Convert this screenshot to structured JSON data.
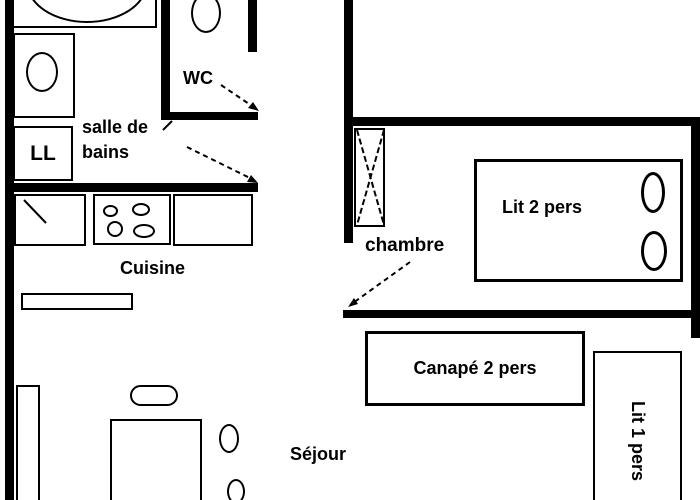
{
  "colors": {
    "ink": "#000000",
    "paper": "#ffffff"
  },
  "rooms": {
    "salle_de_bains": {
      "line1": "salle de",
      "line2": "bains"
    },
    "wc": {
      "label": "WC"
    },
    "cuisine": {
      "label": "Cuisine"
    },
    "chambre": {
      "label": "chambre"
    },
    "sejour": {
      "label": "Séjour"
    }
  },
  "furniture": {
    "washing_machine": {
      "label": "LL"
    },
    "double_bed": {
      "label": "Lit 2 pers"
    },
    "sofa": {
      "label": "Canapé 2 pers"
    },
    "single_bed": {
      "label": "Lit 1 pers"
    }
  }
}
